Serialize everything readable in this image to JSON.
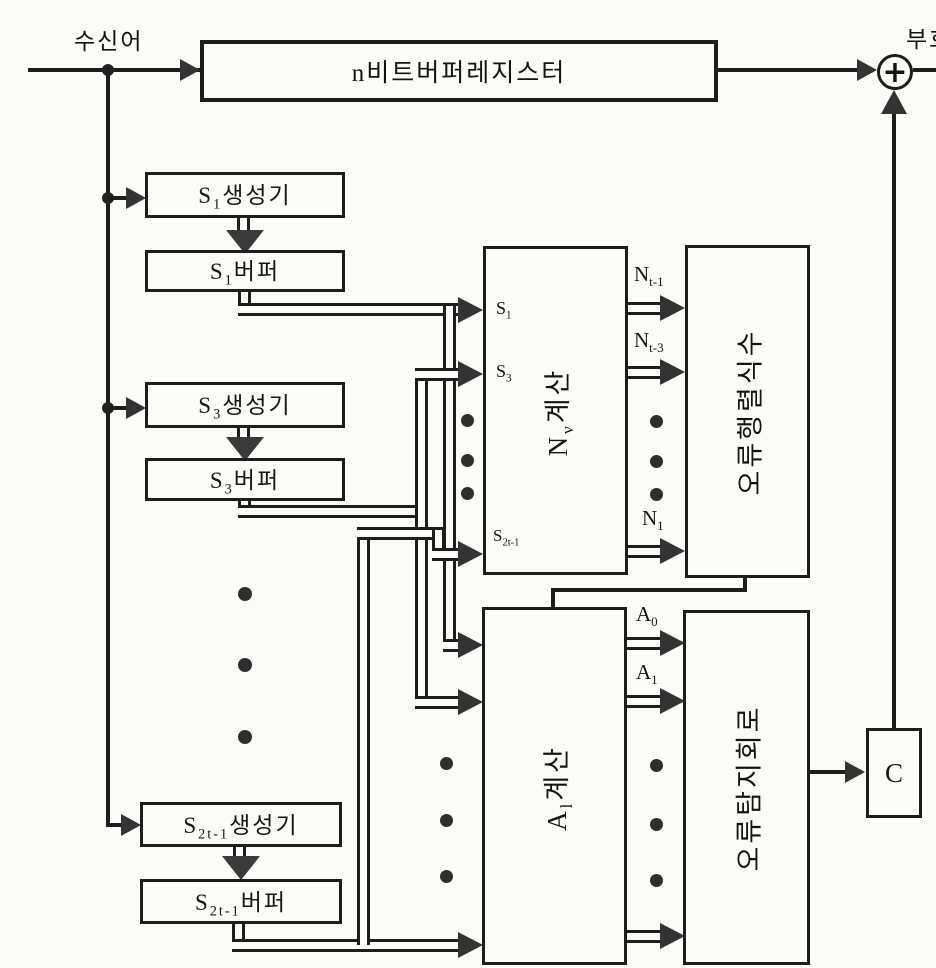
{
  "top": {
    "received_word": "수신어",
    "codeword": "부호",
    "buffer_register": {
      "base": "n",
      "rest": "비트버퍼레지스터"
    },
    "adder_symbol": "+"
  },
  "syndrome_column": {
    "s1_generator": {
      "base": "S",
      "sub": "1",
      "rest": "생성기"
    },
    "s1_buffer": {
      "base": "S",
      "sub": "1",
      "rest": "버퍼"
    },
    "s3_generator": {
      "base": "S",
      "sub": "3",
      "rest": "생성기"
    },
    "s3_buffer": {
      "base": "S",
      "sub": "3",
      "rest": "버퍼"
    },
    "s2t1_generator": {
      "base": "S",
      "sub": "2t-1",
      "rest": "생성기"
    },
    "s2t1_buffer": {
      "base": "S",
      "sub": "2t-1",
      "rest": "버퍼"
    }
  },
  "blocks": {
    "n_calc": {
      "base": "N",
      "sub": "ν",
      "rest": "계산"
    },
    "error_determinant": "오류행렬식수",
    "a_calc": {
      "base": "A",
      "sub": "l",
      "rest": "계산"
    },
    "error_detector": "오류탐지회로",
    "c_unit": "C"
  },
  "signals": {
    "in_s1": {
      "base": "S",
      "sub": "1"
    },
    "in_s3": {
      "base": "S",
      "sub": "3"
    },
    "in_s2t1": {
      "base": "S",
      "sub": "2t-1"
    },
    "out_nt1": {
      "base": "N",
      "sub": "t-1"
    },
    "out_nt3": {
      "base": "N",
      "sub": "t-3"
    },
    "out_n1": {
      "base": "N",
      "sub": "1"
    },
    "out_a0": {
      "base": "A",
      "sub": "0"
    },
    "out_a1": {
      "base": "A",
      "sub": "1"
    }
  }
}
